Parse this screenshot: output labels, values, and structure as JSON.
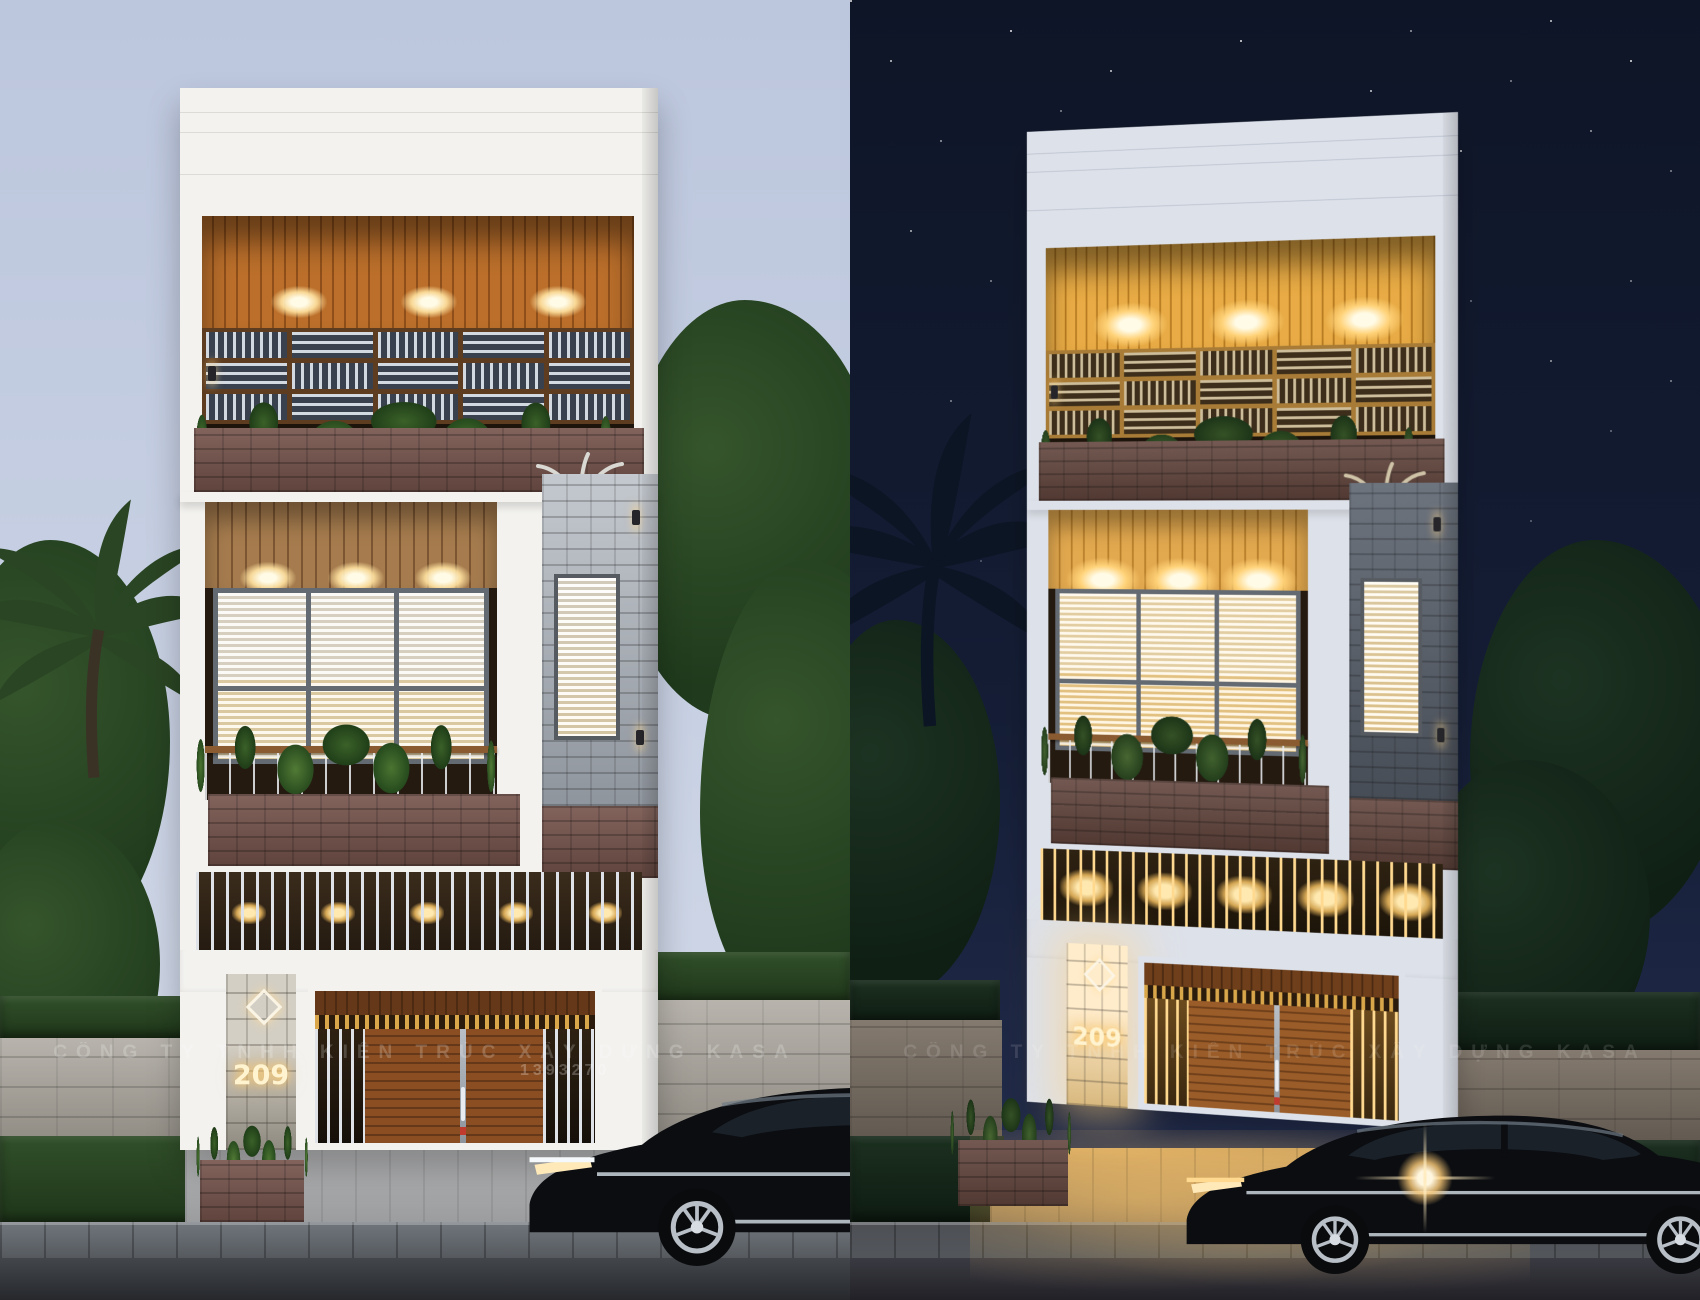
{
  "scene": {
    "description": "Two 3D renders of the same three-storey modern townhouse facade, daytime on the left and nighttime on the right",
    "house_number": "209",
    "watermark_text": "CÔNG TY TNHH KIẾN TRÚC XÂY DỰNG KASA",
    "watermark_number": "1393270",
    "panels": {
      "left": "daytime render",
      "right": "nighttime render"
    }
  },
  "colors": {
    "day_sky_top": "#bcc6dd",
    "day_sky_bottom": "#d3dae8",
    "night_sky_top": "#0e1527",
    "night_sky_bottom": "#253052",
    "facade_white": "#f3f2ef",
    "ceiling_wood": "#bb6f2b",
    "planter_brick": "#74524a",
    "warm_light": "#ffd98f",
    "hedge_green": "#31502a",
    "asphalt": "#43474c"
  }
}
